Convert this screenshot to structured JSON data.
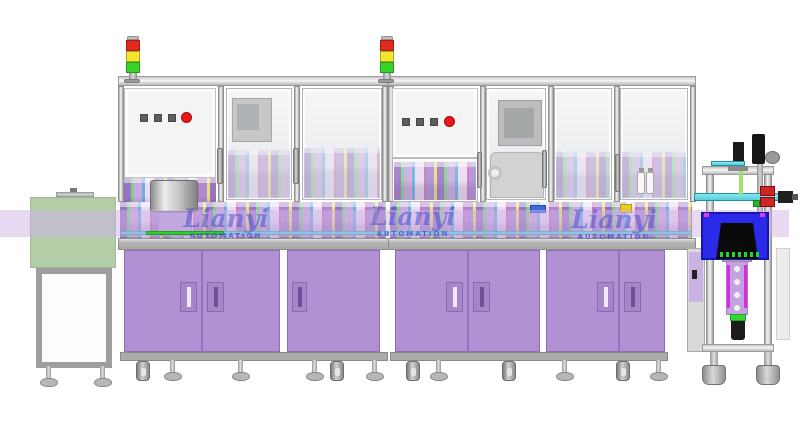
{
  "watermarks": [
    {
      "brand": "Lianyi",
      "sub": "AUTOMATION"
    },
    {
      "brand": "Lianyi",
      "sub": "AUTOMATION"
    },
    {
      "brand": "Lianyi",
      "sub": "AUTOMATION"
    }
  ],
  "palette": {
    "cabinet_purple": "#b191d3",
    "overlay_lavender": "#cfb4e6",
    "machine_green": "#a9c79b",
    "inspection_blue": "#2a2ae8",
    "conveyor_teal": "#55cddb",
    "estop_red": "#ee1616",
    "tower_red": "#e02a20",
    "tower_yellow": "#f2e52c",
    "tower_green": "#3cd22c",
    "watermark_blue": "#4852cd"
  }
}
